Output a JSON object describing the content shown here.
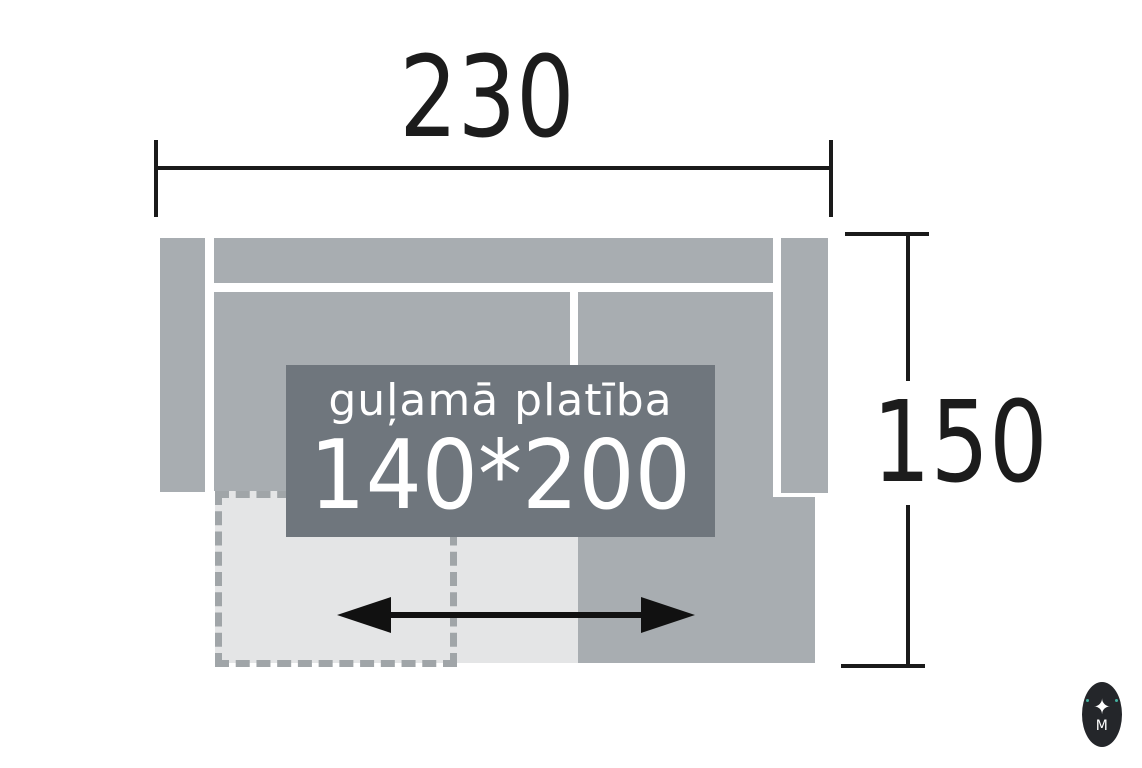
{
  "diagram": {
    "overall_width": "230",
    "overall_depth": "150",
    "sleeping_area_label": "guļamā platība",
    "sleeping_area_size": "140*200"
  },
  "logo": {
    "star_icon": "✦",
    "monogram": "M"
  },
  "colors": {
    "background": "#ffffff",
    "sofa_body": "#a8adb1",
    "pullout_light": "#e4e5e6",
    "sleeping_label_bg": "#6f767d",
    "sleeping_label_text": "#ffffff",
    "dashed_outline": "#a0a5a8",
    "dimension_lines": "#1a1a1a",
    "arrow": "#111111",
    "logo_bg": "#24262a",
    "logo_foreground": "#ffffff",
    "logo_accent_teal": "#43b0a0"
  }
}
